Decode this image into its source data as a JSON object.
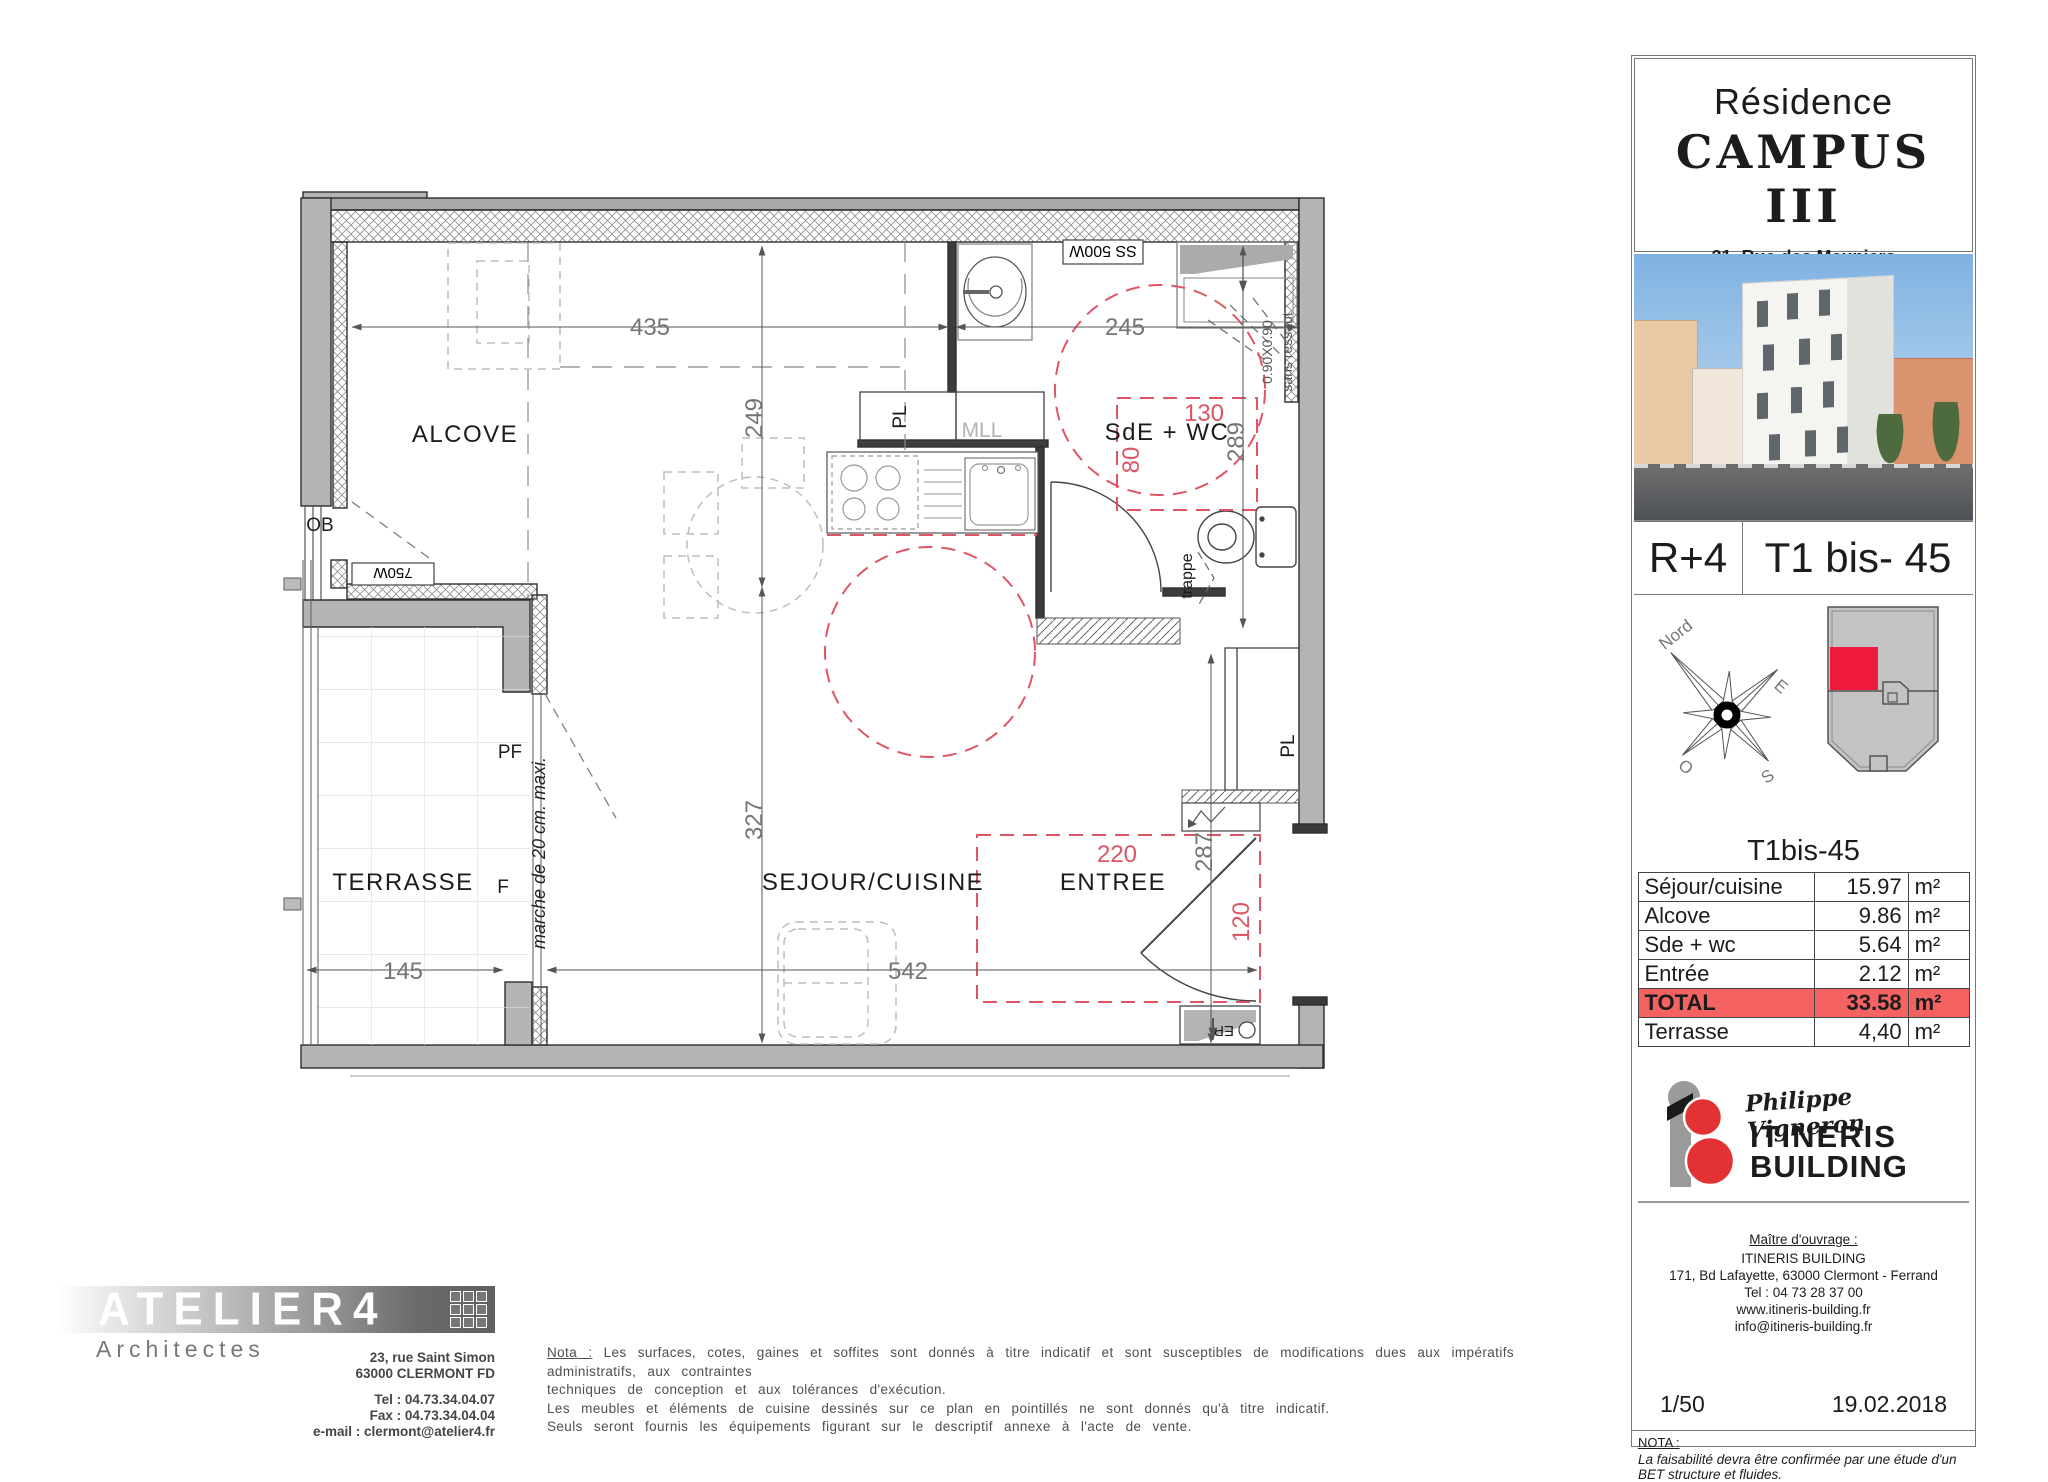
{
  "plan": {
    "rooms": {
      "alcove": "ALCOVE",
      "terrasse": "TERRASSE",
      "sejour": "SEJOUR/CUISINE",
      "entree": "ENTREE",
      "sde": "SdE + WC"
    },
    "fixtures": {
      "ob": "OB",
      "pf": "PF",
      "f": "F",
      "pl_bath": "PL",
      "pl_entree": "PL",
      "mll": "MLL",
      "ep": "EP",
      "trappe": "trappe",
      "radiator_bath": "SS 500W",
      "radiator_alcove": "750W",
      "shower_size": "0.90X0.90",
      "shower_note": "sans ressaut",
      "step_note": "marche de 20 cm. maxi."
    },
    "dims": {
      "d435": "435",
      "d249": "249",
      "d245": "245",
      "d289": "289",
      "d327": "327",
      "d542": "542",
      "d145": "145",
      "d287": "287"
    },
    "red_dims": {
      "d130": "130",
      "d80": "80",
      "d220": "220",
      "d120": "120"
    }
  },
  "panel": {
    "residence": "Résidence",
    "name": "CAMPUS III",
    "address1": "31, Rue des Meuniers",
    "address2": "63000 CLERMONT - FERRAND",
    "floor": "R+4",
    "unit": "T1 bis- 45",
    "compass": {
      "n": "Nord",
      "e": "E",
      "o": "O",
      "s": "S"
    },
    "table": {
      "title": "T1bis-45",
      "rows": [
        {
          "label": "Séjour/cuisine",
          "value": "15.97",
          "unit": "m²"
        },
        {
          "label": "Alcove",
          "value": "9.86",
          "unit": "m²"
        },
        {
          "label": "Sde + wc",
          "value": "5.64",
          "unit": "m²"
        },
        {
          "label": "Entrée",
          "value": "2.12",
          "unit": "m²"
        },
        {
          "label": "TOTAL",
          "value": "33.58",
          "unit": "m²"
        },
        {
          "label": "Terrasse",
          "value": "4,40",
          "unit": "m²"
        }
      ]
    },
    "brand": {
      "script": "Philippe Vigneron",
      "line1": "ITINERIS",
      "line2": "BUILDING"
    },
    "owner": {
      "heading": "Maître d'ouvrage  :",
      "name": "ITINERIS BUILDING",
      "address": "171, Bd Lafayette, 63000 Clermont - Ferrand",
      "tel": "Tel : 04 73 28 37 00",
      "web": "www.itineris-building.fr",
      "email": "info@itineris-building.fr"
    },
    "scale": "1/50",
    "date": "19.02.2018",
    "nota_heading": "NOTA :",
    "nota_text": "La faisabilité devra être confirmée par une étude d'un BET structure et fluides."
  },
  "architect": {
    "logo": "ATELIER4",
    "subtitle": "Architectes",
    "address1": "23, rue Saint Simon",
    "address2": "63000 CLERMONT FD",
    "tel": "Tel : 04.73.34.04.07",
    "fax": "Fax : 04.73.34.04.04",
    "email": "e-mail : clermont@atelier4.fr"
  },
  "footnote": {
    "label": "Nota :",
    "line1": "Les surfaces, cotes, gaines et soffites sont donnés à titre indicatif et sont susceptibles de modifications dues aux impératifs administratifs, aux contraintes",
    "line2": "techniques de conception et aux tolérances d'exécution.",
    "line3": "Les meubles et éléments de cuisine dessinés sur ce plan en pointillés ne sont donnés qu'à titre indicatif.",
    "line4": "Seuls seront fournis les équipements figurant sur le descriptif annexe à l'acte de vente."
  },
  "colors": {
    "wall_fill": "#b4b4b4",
    "wall_stroke": "#2e2e2e",
    "dim_gray": "#757575",
    "plan_red": "#e05565",
    "site_red": "#ef1a3c",
    "total_row": "#f56262",
    "sky": "#7fb2e2"
  }
}
